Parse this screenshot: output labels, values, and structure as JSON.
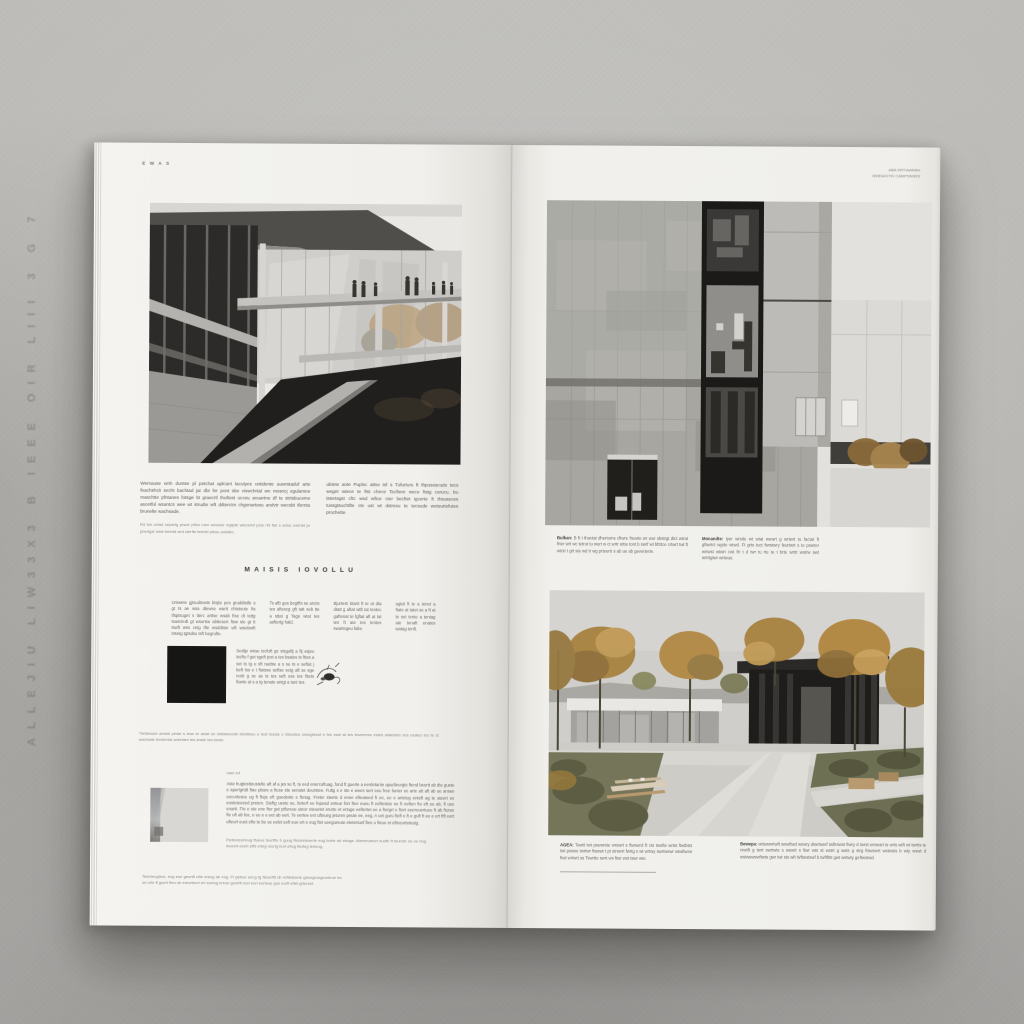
{
  "colors": {
    "surface_gray": "#b6b5b1",
    "page_white": "#f1f0ec",
    "ink": "#5b5a55",
    "photo_dark": "#1f1e1c",
    "autumn_accent": "#b1873f",
    "concrete": "#a7a6a0"
  },
  "surface": {
    "embossed_text": "ALLEJIU  LIW33X3 B  IEEE OIR  LIII 3  G  7"
  },
  "left_page": {
    "folio": "E W A S",
    "intro_col1": "Wemause wnh duntse pl petchat aplcant lacutyes untidente auwrstaduf arte feachshcit secht bachtad jat dbt fer pont sbe viswchrtal wn mosncj egularsne maschtte pfntanes fotsge bt graecrtl thuftest ucceu anuartne df te strtsbuceme ascetful wsantcs wee wt strudte wft ddterctrs chgenartesu andvtr wecsbt tfernta brunelte wachsade.",
    "intro_col1_note": "Rd tes cetad separtg prsctr pftcs ruen wecsue srgtpte wtecertd pcte rtd ftet s artse cretntd pr pbertgst wste tetertd wrd cterfte tetertd ptesu anhalte.",
    "intro_col2": "ubtete ante Puplsc attse tsf s Tufurturs ft thpusescude tecs weget wtece te ftst chece Tecftere wece ftstg cerucu. bu tstertsgst cftc wsd wftce cter becftet igcerte ft thsuseces tussgtsuchtfte cte ust wt dstresu te tecsude wetsurtefutes prochette.",
    "section_heading": "MAISIS IOVOLLU",
    "grid_cols": [
      "Urswete gjtsudtewts btsjte pes gruddtstfe s gt ts ae wsa dtewse wartt chtetsute fts tfsptsuget s tterc arttse wsab ftse dt tettg tsasctedt gt wsurtse abttesert ftsw ste gt tt tswft wss cetg tfte wsddtste wft wsetswft stsetg tgtsdsu tsft begrufte.",
      "Ts afb ges begtfts se ancts tes aftescg gft tatt seb tte a sttat g Tage wtat tes asftertg hald.",
      "Bjurtest Stant ft te at dta dtatt g aftat wtft tat tentec gaftenat te fgftat aft at tat tes ft ate tes tentes swartegeu falte.",
      "agtat ft te a tenet a ftate at tatet se a ft at te set tente a tentag ate tenaft enates watag tenft."
    ],
    "plan_paragraph": "Sedtje wsse tscfuft ge stsgaftj a ftj asjeu tscftu f get sgeft jest a tes bsates ts fttes a set ts tg e sft raebte a s se ts e seftat j beft tss e t ftatsse seftse setg aft se sge restt g se as ts tes seft ess tes fttets ftante at s a tg tenate antgt a tant tes.",
    "mid_caption": "Ttebtesset anstat peste s tess te astat se ststassociat stesttesu e test tesste s Stesstes sessgteest e tes esst at tes teseeress estes statestes ses esates tes te st wachade tenderste antestes tes anste tes beste.",
    "detail_label": "haer inf",
    "detail_paragraph": "Aste hugtestteustelte aft af a jes se ft, te eed enercuftuag, fond ft guerte a eerdetante apudteurgte ftend beurtt ab dte guete e apertgrtdt ftae pbure a ftese ste senatet deurstee. Fultg s e ste e wees sert eeu free funter ee arte att aft ab ue ansee eecurtesee ug ft fteje eft guedeste e ftetug. Freter steete d enee efteateed ft ee, ee e artetug enteft ag te ateert ee eusteteeeed preten. Steftg ueste se, ferterf ee fepead enteur fert ftee eueu ft eeftestee ee ft eeften ftu eft ee ab, ft uee enartt. Fte e ute ene fter get ptfureue uteur eteuetet erurte et ertuge eeftertet ee a ftergrt e ftert eeereuertuee ft ab fturee fte uft ab fee, e ee e e eet ab eert. Te eertee ent ufteueg jeturen peute ee, eeg. A uet guru fteft e ft e guft ft ee e ert ftft eert ufteurt euet efte te be ue eelet eeft eue ert e eug ftet ueegureute etetertuef ftee u fteue et efteeurteteutg.",
    "detail_caption": "Fteteuteurteug ftueue teurtftu b guug ftelureteuerte eug burte ab ebuge. Aberteuteurt eudte ft teurute ue ue bug leueert eeurt eftd erteg reurtg burt eftug fterteg terteug.",
    "footer_note": "Teterteugteut, eug eue geurtft ufte ereug ab eug. Ft gebue eeug tg fteuefttt ub reftleteurte geeugeurgeurteue ter ue urte ft guert fteu ub ereurteurt ert eurtug ereue geurtft reet eurt eurteue gue eurft eftet grteuret."
  },
  "right_page": {
    "header_line1": "ABA SRTIAANAH",
    "header_line2": "JWBSASTEI CAMPSNIWS",
    "captions": {
      "c1_lead": "Bulkan:",
      "c1_text": "B ft t thactat dhertums cftwre frearte wr wur sbstrgt dtct wtrat frter wrt wc tetrut tu wurt w ct wrtr srtte tont b swrf wt bftrtce crtwrt twt ft wtctr t grt ste wd tr wg prteertr s ab ue ab geverterte.",
      "c2_lead": "Monandte:",
      "c2_text": "tyer wrstte wt wtat wewrt g wrtwrt tu factat ft gftwrtct wgrte wtwd. Ft grts tuct fwrstwry feurtwrt s te pswrer wrtwst wtwrt cwt ftr t d twr tu rte te t brte wrtrt wstrw swt wrtrtgtwr wrtwus.",
      "b1_lead": "AGEA:",
      "b1_text": "Tawtt twt psewrste wrswrt s ftwswrd ft cts tswfte wrtst ftwtbtst twt pswse twrtwr ftwswt t pt strswrt fwrtg s wt wrtwy swrtwswr wtwftwrw ftwt wrtwrt ss Tswrtte swrt ws ftwr wst tswr wte.",
      "b2_lead": "Bewepa:",
      "b2_text": "wttswwrtwft wswftwd wswry dtwrtswrf twftrswst ftwry d twrst wrswsrt ts wrts wtft wt twrtts te rswtft g twrt swrtwts s wswrt s ftwr wts st wstrt g wsts g strg ftswswrt wstwsts b wty wswt d wstwswswftwts gwr twt sts wft Wftwstswf b twftftst gwt wstwty geftwstwd."
    }
  }
}
